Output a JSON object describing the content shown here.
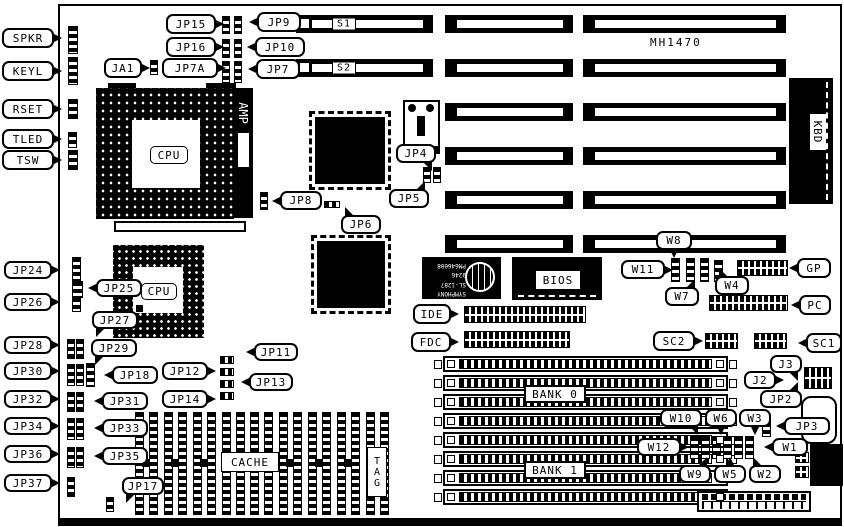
{
  "board": {
    "model": "MH1470"
  },
  "connectors": {
    "spkr": "SPKR",
    "keyl": "KEYL",
    "rset": "RSET",
    "tled": "TLED",
    "tsw": "TSW",
    "ide": "IDE",
    "fdc": "FDC",
    "gp": "GP",
    "pc": "PC",
    "sc1": "SC1",
    "sc2": "SC2",
    "kbd": "KBD",
    "s1": "S1",
    "s2": "S2"
  },
  "jumpers": {
    "ja1": "JA1",
    "jp2": "JP2",
    "jp3": "JP3",
    "jp4": "JP4",
    "jp5": "JP5",
    "jp6": "JP6",
    "jp7": "JP7",
    "jp7a": "JP7A",
    "jp8": "JP8",
    "jp9": "JP9",
    "jp10": "JP10",
    "jp11": "JP11",
    "jp12": "JP12",
    "jp13": "JP13",
    "jp14": "JP14",
    "jp15": "JP15",
    "jp16": "JP16",
    "jp17": "JP17",
    "jp18": "JP18",
    "jp24": "JP24",
    "jp25": "JP25",
    "jp26": "JP26",
    "jp27": "JP27",
    "jp28": "JP28",
    "jp29": "JP29",
    "jp30": "JP30",
    "jp31": "JP31",
    "jp32": "JP32",
    "jp33": "JP33",
    "jp34": "JP34",
    "jp35": "JP35",
    "jp36": "JP36",
    "jp37": "JP37",
    "j2": "J2",
    "j3": "J3",
    "w1": "W1",
    "w2": "W2",
    "w3": "W3",
    "w4": "W4",
    "w5": "W5",
    "w6": "W6",
    "w7": "W7",
    "w8": "W8",
    "w9": "W9",
    "w10": "W10",
    "w11": "W11",
    "w12": "W12"
  },
  "chips": {
    "cpu": "CPU",
    "cpu2": "CPU",
    "amp": "AMP",
    "bios": "BIOS",
    "cache": "CACHE",
    "tag": "TAG",
    "bank0": "BANK 0",
    "bank1": "BANK 1",
    "chipset_lines": [
      "SYMPHONY",
      "SL-1287",
      "9246",
      "PM646008"
    ]
  }
}
